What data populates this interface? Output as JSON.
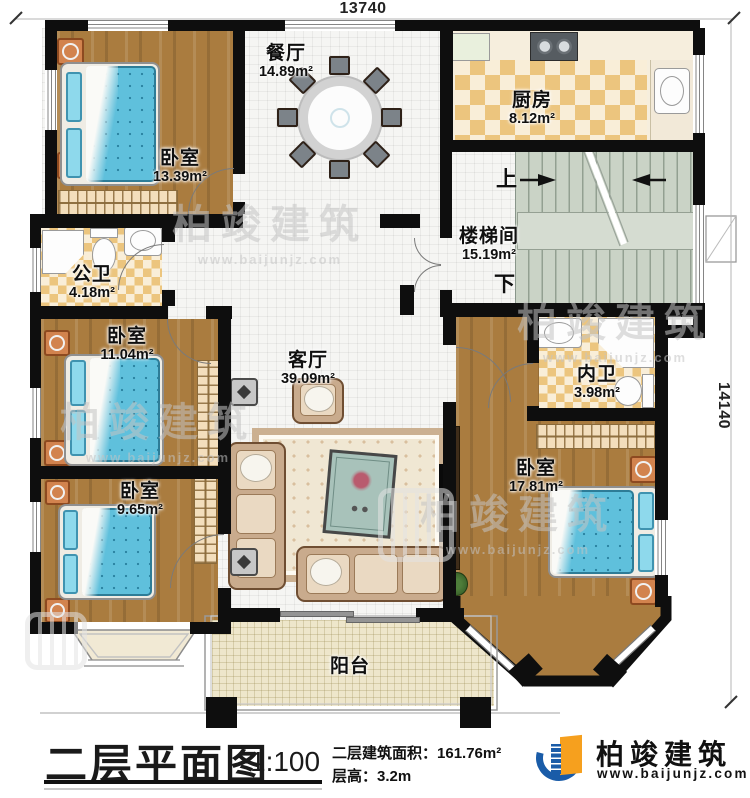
{
  "dimensions": {
    "top": "13740",
    "right": "14140"
  },
  "rooms": {
    "bedroom_top_left": {
      "label": "卧室",
      "area": "13.39m²"
    },
    "dining": {
      "label": "餐厅",
      "area": "14.89m²"
    },
    "kitchen": {
      "label": "厨房",
      "area": "8.12m²"
    },
    "stairwell": {
      "label": "楼梯间",
      "area": "15.19m²",
      "up_label": "上",
      "down_label": "下"
    },
    "public_bath": {
      "label": "公卫",
      "area": "4.18m²"
    },
    "bedroom_mid_left": {
      "label": "卧室",
      "area": "11.04m²"
    },
    "living": {
      "label": "客厅",
      "area": "39.09m²"
    },
    "private_bath": {
      "label": "内卫",
      "area": "3.98m²"
    },
    "bedroom_right": {
      "label": "卧室",
      "area": "17.81m²"
    },
    "bedroom_bottom_left": {
      "label": "卧室",
      "area": "9.65m²"
    },
    "balcony": {
      "label": "阳台"
    }
  },
  "title_block": {
    "title": "二层平面图",
    "scale": "1:100",
    "floor_area_label": "二层建筑面积：",
    "floor_area_value": "161.76m²",
    "floor_height_label": "层高：",
    "floor_height_value": "3.2m"
  },
  "brand": {
    "name": "柏竣建筑",
    "website": "www.baijunjz.com"
  },
  "watermark": {
    "name": "柏竣建筑",
    "website": "www.baijunjz.com"
  }
}
